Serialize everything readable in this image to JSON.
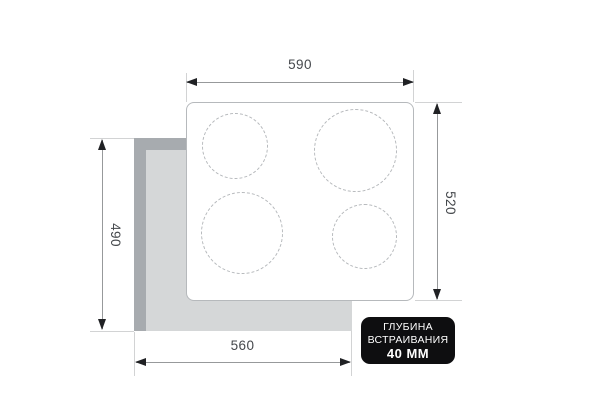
{
  "dimensions": {
    "top_width": "590",
    "right_depth": "520",
    "left_cutout_depth": "490",
    "bottom_cutout_width": "560"
  },
  "badge": {
    "line1": "ГЛУБИНА",
    "line2": "ВСТРАИВАНИЯ",
    "line3": "40 ММ"
  },
  "colors": {
    "badge_bg": "#0e0e10",
    "badge_text": "#ffffff",
    "cutout_fill": "#d5d7d8",
    "cutout_edge": "#a7abaf",
    "panel_fill": "#ffffff",
    "panel_border": "#b6b9bc",
    "burner_dash": "#b6b9bc",
    "extension_line": "#d2d3d4",
    "dimension_line": "#97999b",
    "arrowhead": "#202124",
    "label_text": "#45484c"
  }
}
